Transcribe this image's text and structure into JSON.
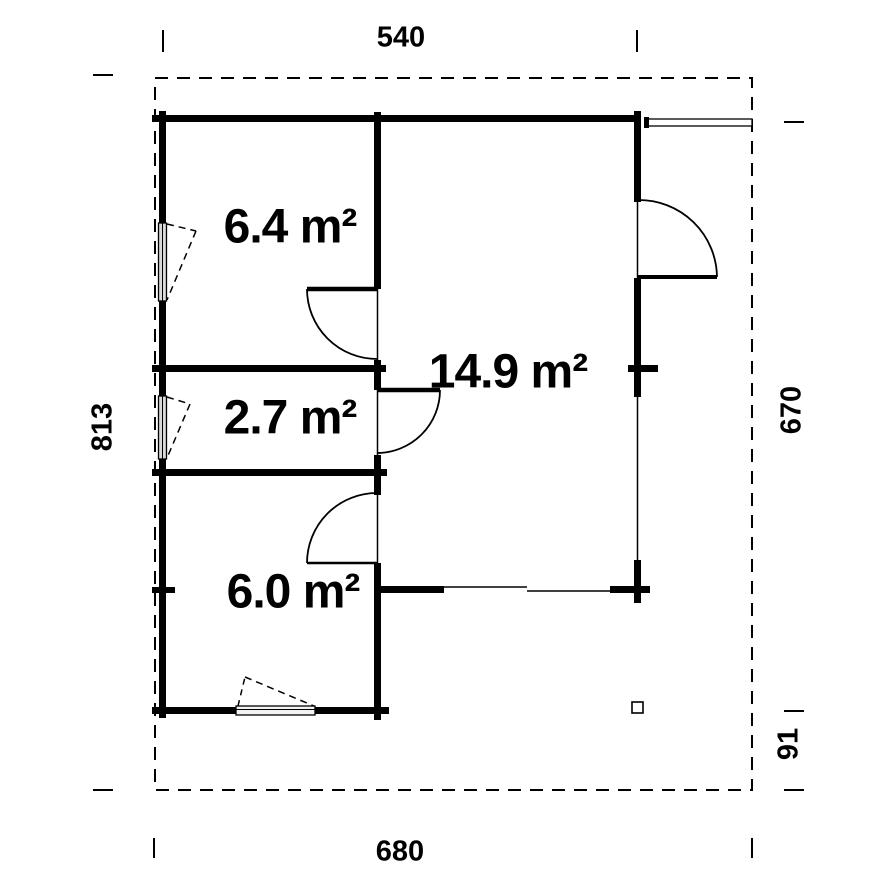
{
  "floor_plan": {
    "rooms": [
      {
        "id": "room-top-left",
        "area_label": "6.4 m²"
      },
      {
        "id": "room-middle-left",
        "area_label": "2.7 m²"
      },
      {
        "id": "room-bottom-left",
        "area_label": "6.0 m²"
      },
      {
        "id": "hall",
        "area_label": "14.9 m²"
      }
    ],
    "dimensions": {
      "top_width": "540",
      "bottom_width": "680",
      "left_height": "813",
      "right_height": "670",
      "right_lower_depth": "91"
    },
    "colors": {
      "lines": "#000000",
      "background": "#ffffff",
      "window_fill": "#d9d9d9"
    }
  }
}
